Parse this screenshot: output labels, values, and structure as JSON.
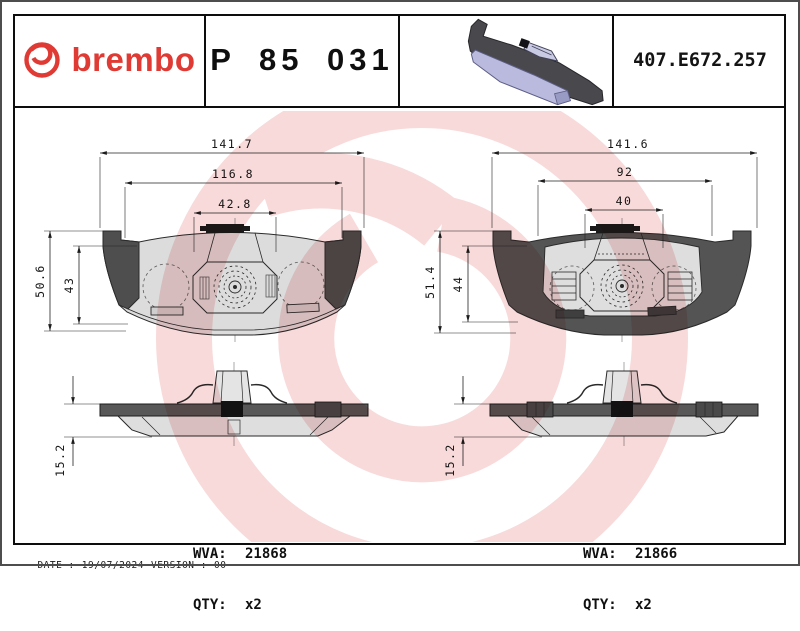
{
  "header": {
    "brand": "brembo",
    "brand_color": "#e03a34",
    "part_number": "P 85 031",
    "catalog_code": "407.E672.257",
    "pad_3d_icon": "brake-pad-3d",
    "pad_face_color": "#b9badd",
    "pad_back_color": "#48484d"
  },
  "watermark": {
    "icon": "brembo-roundel-watermark",
    "color": "#f8dada"
  },
  "drawings": {
    "left": {
      "widths": [
        "141.7",
        "116.8",
        "42.8"
      ],
      "heights": [
        "50.6",
        "43"
      ],
      "thickness": "15.2",
      "wva_label": "WVA:",
      "wva": "21868",
      "qty_label": "QTY:",
      "qty": "x2"
    },
    "right": {
      "widths": [
        "141.6",
        "92",
        "40"
      ],
      "heights": [
        "51.4",
        "44"
      ],
      "thickness": "15.2",
      "wva_label": "WVA:",
      "wva": "21866",
      "qty_label": "QTY:",
      "qty": "x2"
    }
  },
  "footer": {
    "date_label": "DATE :",
    "date": "19/07/2024",
    "version_label": "VERSION :",
    "version": "00"
  }
}
